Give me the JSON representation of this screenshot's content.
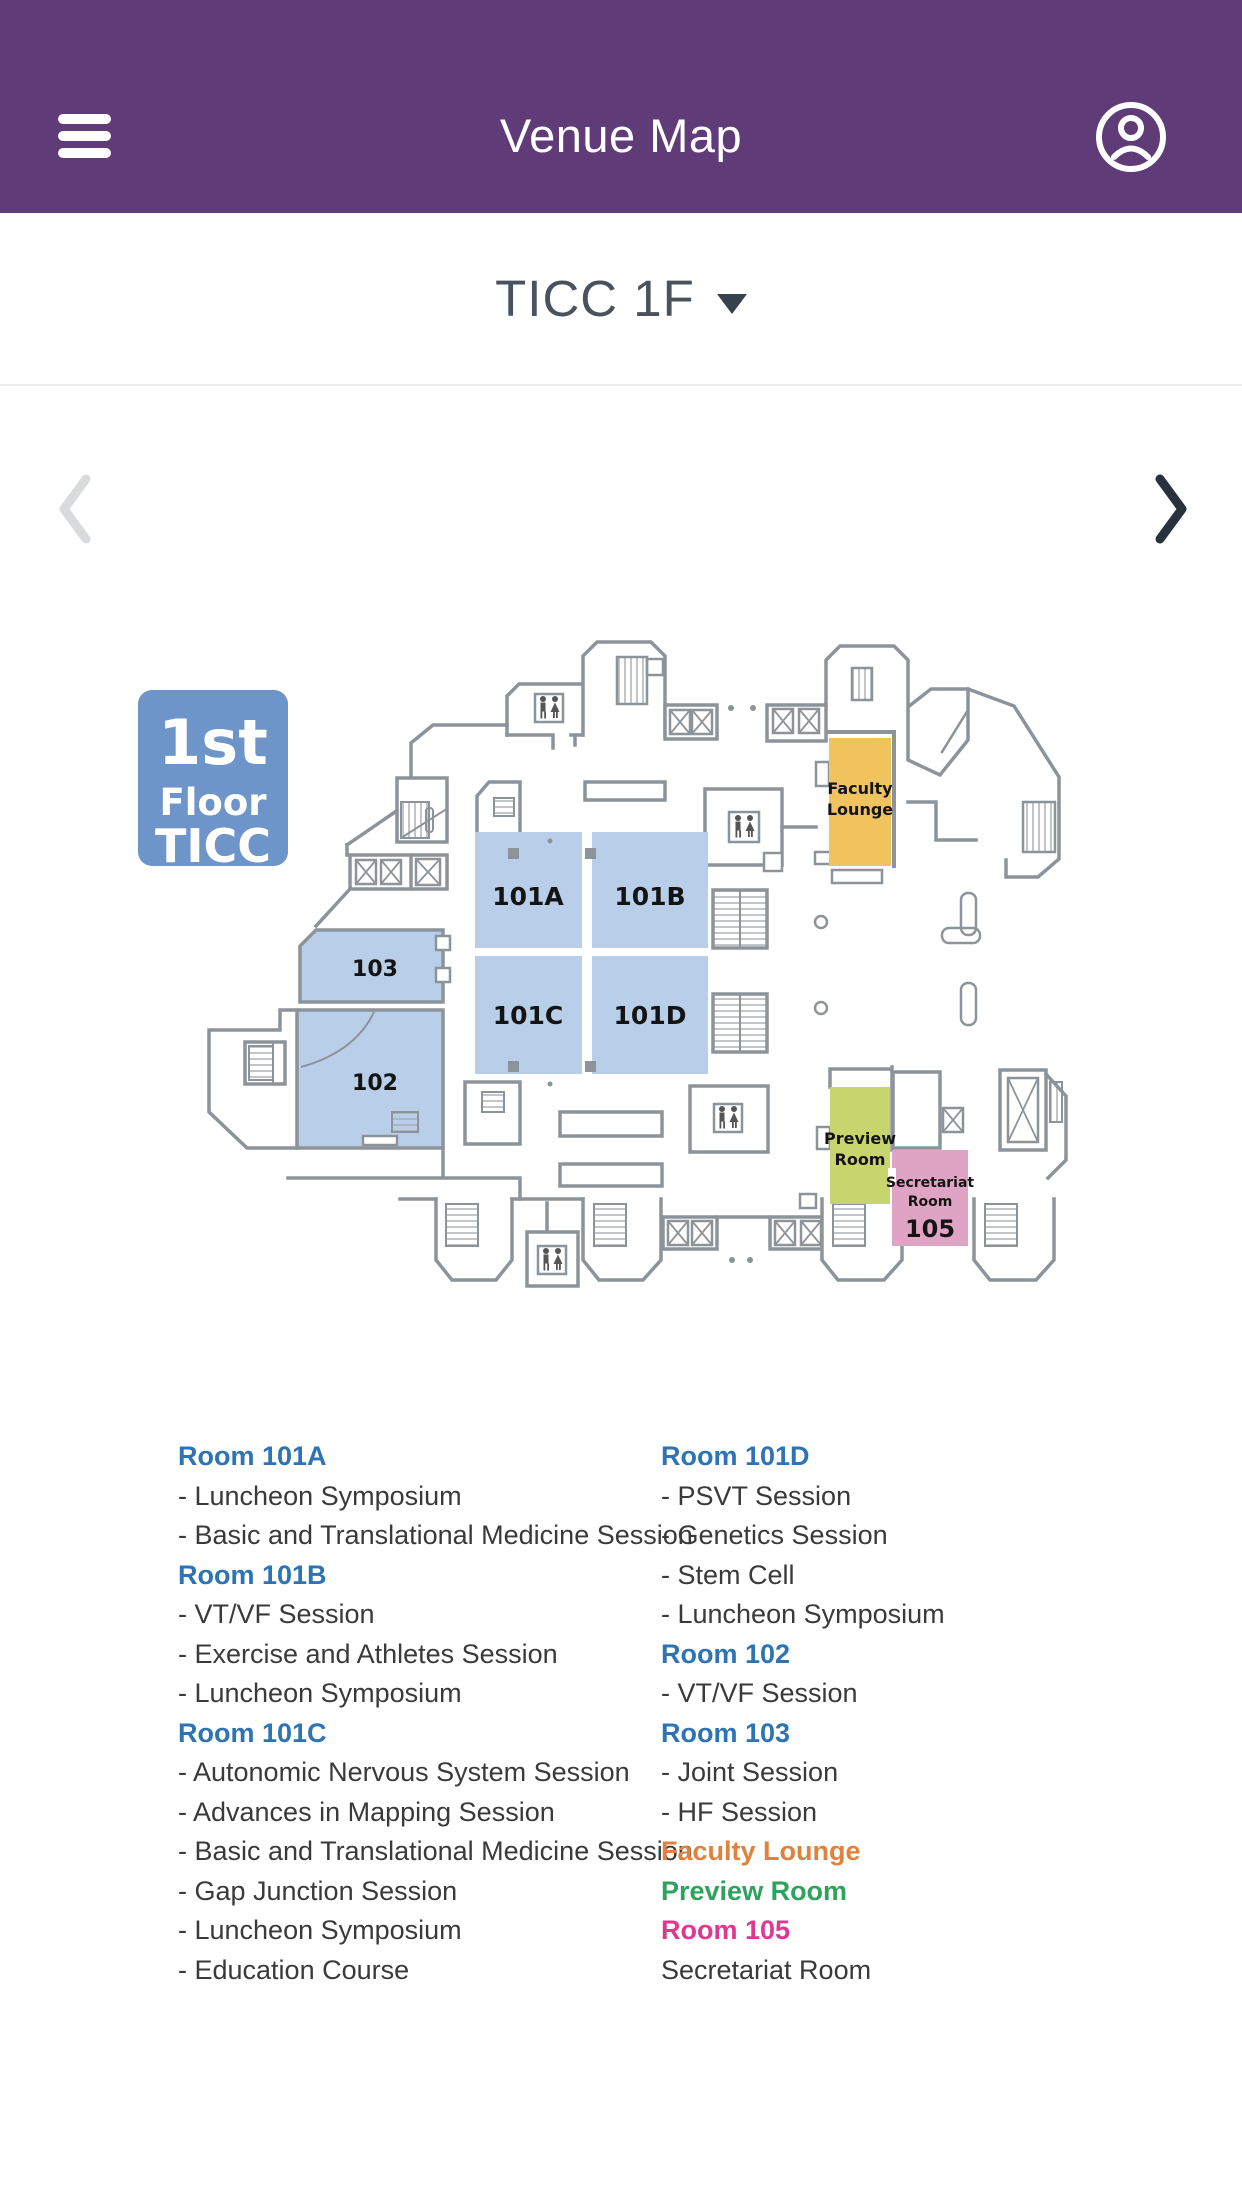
{
  "header": {
    "title": "Venue Map",
    "menu_icon": "hamburger-menu",
    "profile_icon": "account-circle"
  },
  "floor_selector": {
    "current": "TICC 1F",
    "prev_icon": "chevron-left",
    "next_icon": "chevron-right",
    "dropdown_icon": "caret-down"
  },
  "map": {
    "badge": {
      "line1": "1st",
      "line2": "Floor",
      "line3": "TICC"
    },
    "rooms": {
      "r101a": "101A",
      "r101b": "101B",
      "r101c": "101C",
      "r101d": "101D",
      "r102": "102",
      "r103": "103",
      "faculty_line1": "Faculty",
      "faculty_line2": "Lounge",
      "preview_line1": "Preview",
      "preview_line2": "Room",
      "secretariat_line1": "Secretariat",
      "secretariat_line2": "Room",
      "secretariat_number": "105"
    },
    "colors": {
      "header_purple": "#5F3C78",
      "badge_blue": "#6D95C9",
      "room_blue": "#B9CFE9",
      "faculty_yellow": "#F0C35E",
      "preview_green": "#C6D66C",
      "secretariat_pink": "#DFA4C4",
      "wall_gray": "#8D9499",
      "heading_blue": "#2E74B5",
      "heading_orange": "#E2813B",
      "heading_green": "#2FA25C",
      "heading_pink": "#DE3890"
    }
  },
  "legend": {
    "left": [
      {
        "type": "room-blue",
        "text": "Room 101A"
      },
      {
        "type": "session",
        "text": "- Luncheon Symposium"
      },
      {
        "type": "session",
        "text": "- Basic and Translational Medicine Session"
      },
      {
        "type": "room-blue",
        "text": "Room 101B"
      },
      {
        "type": "session",
        "text": "- VT/VF Session"
      },
      {
        "type": "session",
        "text": "- Exercise and Athletes Session"
      },
      {
        "type": "session",
        "text": "- Luncheon Symposium"
      },
      {
        "type": "room-blue",
        "text": "Room 101C"
      },
      {
        "type": "session",
        "text": "- Autonomic Nervous System Session"
      },
      {
        "type": "session",
        "text": "- Advances in Mapping Session"
      },
      {
        "type": "session",
        "text": "- Basic and Translational Medicine Session"
      },
      {
        "type": "session",
        "text": "- Gap Junction Session"
      },
      {
        "type": "session",
        "text": "- Luncheon Symposium"
      },
      {
        "type": "session",
        "text": "- Education Course"
      }
    ],
    "right": [
      {
        "type": "room-blue",
        "text": "Room 101D"
      },
      {
        "type": "session",
        "text": "- PSVT Session"
      },
      {
        "type": "session",
        "text": "- Genetics Session"
      },
      {
        "type": "session",
        "text": "- Stem Cell"
      },
      {
        "type": "session",
        "text": "- Luncheon Symposium"
      },
      {
        "type": "room-blue",
        "text": "Room 102"
      },
      {
        "type": "session",
        "text": "- VT/VF Session"
      },
      {
        "type": "room-blue",
        "text": "Room 103"
      },
      {
        "type": "session",
        "text": "- Joint Session"
      },
      {
        "type": "session",
        "text": "- HF Session"
      },
      {
        "type": "room-orange",
        "text": "Faculty Lounge"
      },
      {
        "type": "room-green",
        "text": "Preview Room"
      },
      {
        "type": "room-pink",
        "text": "Room 105"
      },
      {
        "type": "plain",
        "text": "Secretariat Room"
      }
    ]
  }
}
